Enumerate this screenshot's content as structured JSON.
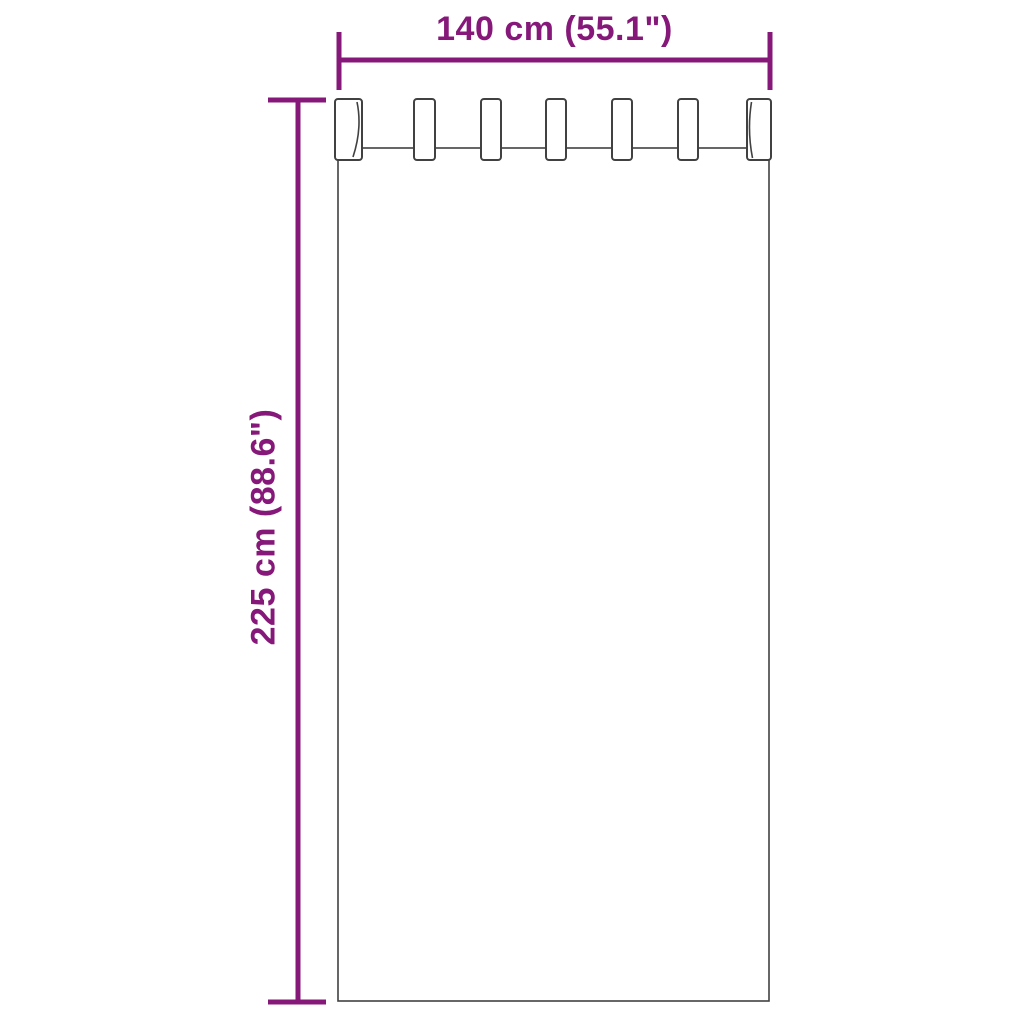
{
  "diagram": {
    "width_dimension": {
      "label": "140 cm (55.1\")",
      "value_cm": 140,
      "value_inch": 55.1
    },
    "height_dimension": {
      "label": "225 cm (88.6\")",
      "value_cm": 225,
      "value_inch": 88.6
    },
    "curtain": {
      "tab_count": 7
    },
    "colors": {
      "dimension_lines": "#851879",
      "curtain_outline": "#414141",
      "background": "#ffffff"
    }
  }
}
